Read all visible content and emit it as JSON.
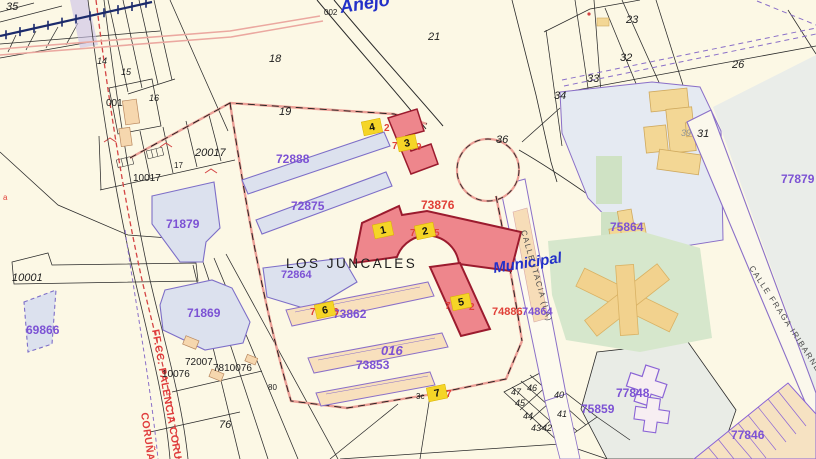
{
  "app": {
    "description": "Cadastral map view with highlighted parcels and numbered result markers",
    "zone_name": "LOS JUNCALES",
    "district_label": "Municipal",
    "annex_label": "Anejo"
  },
  "colors": {
    "background_cream": "#fcf8e5",
    "parcel_fill_bluegray": "#dce1ee",
    "parcel_outline_purple": "#7d6ec8",
    "purple_label": "#7c52d4",
    "red_label": "#e04038",
    "blue_label": "#2230c8",
    "highlight_building_fill": "#ee868c",
    "highlight_building_border": "#9b1b2e",
    "marker_yellow": "#f5d527",
    "building_tan": "#f8e0bd",
    "campus_building_yellow": "#f3d795",
    "green_area": "#d6e7cc",
    "railway_navy": "#1b2a6b",
    "railway_red_dash": "#d44444",
    "boundary_salmon": "#eb9f96"
  },
  "streets": {
    "itacia": "CALLE ITACIA (LA)",
    "fraga": "CALLE FRAGA IRIBARNE",
    "railway": "FF.CC. PALENCIA CORUÑA",
    "railway2": "CORUÑA"
  },
  "markers": {
    "m1": "1",
    "m2": "2",
    "m3": "3",
    "m4": "4",
    "m5": "5",
    "m6": "6",
    "m7": "7"
  },
  "labels": {
    "anejo": "Anejo",
    "municipal": "Municipal",
    "los_juncales": "LOS JUNCALES",
    "p35": "35",
    "p002": "002",
    "p21": "21",
    "p18": "18",
    "p19": "19",
    "p23": "23",
    "p32": "32",
    "p33": "33",
    "p34": "34",
    "p26": "26",
    "p31": "31",
    "p39": "39",
    "p36": "36",
    "p14": "14",
    "p15": "15",
    "p16": "16",
    "p001": "001",
    "p17": "17",
    "p20017": "20017",
    "p10017": "10017",
    "p10001": "10001",
    "pa": "a",
    "p69866": "69866",
    "p71879": "71879",
    "p72888": "72888",
    "p72875": "72875",
    "p73876": "73876",
    "p72864": "72864",
    "p71869": "71869",
    "p73862": "73862",
    "p016": "016",
    "p73853": "73853",
    "p10076": "10076",
    "p72007": "72007",
    "p7810076": "7810076",
    "p76": "76",
    "p80": "80",
    "p3c": "3c",
    "p47": "47",
    "p46": "46",
    "p45": "45",
    "p44": "44",
    "p43": "43",
    "p42": "42",
    "p41": "41",
    "p40": "40",
    "p75864": "75864",
    "p74886": "74886",
    "p74864": "74864",
    "p77879": "77879",
    "p77848": "77848",
    "p75859": "75859",
    "p77846": "77846",
    "frag_m4_right": "2",
    "frag_m3_left": "7",
    "frag_m3_right": "9",
    "frag_m2_left": "7",
    "frag_m2_right": "5",
    "frag_m6_left": "7",
    "frag_m6_right": "6",
    "frag_m5_left": "7",
    "frag_m5_right": "2",
    "frag_m7_right": "7"
  }
}
